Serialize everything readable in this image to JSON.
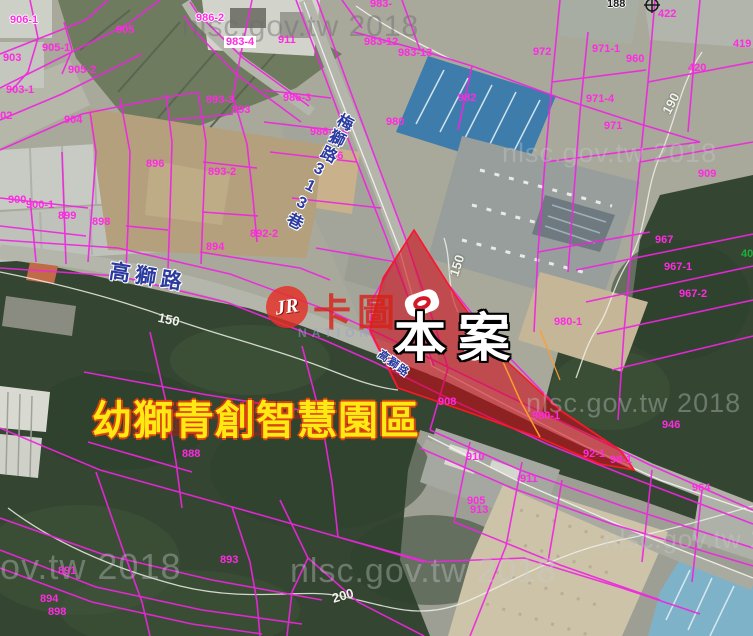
{
  "map": {
    "site_label": "本案",
    "park_label": "幼獅青創智慧園區",
    "ghost_row": "卡圖卡圖卡圖",
    "topmark": "188",
    "logo": {
      "jr": "JR",
      "cn": "卡圖",
      "sub": "NATION"
    },
    "watermarks": [
      {
        "text": "nlsc.gov.tw 2018",
        "x": 182,
        "y": 10,
        "s": 30,
        "dark": 1
      },
      {
        "text": "nlsc.gov.tw 2018",
        "x": 502,
        "y": 138,
        "s": 27,
        "dark": 0
      },
      {
        "text": "nlsc.gov.tw 2018",
        "x": 526,
        "y": 388,
        "s": 27,
        "dark": 0
      },
      {
        "text": "nlsc.gov.tw 2018",
        "x": -100,
        "y": 546,
        "s": 36,
        "dark": 0
      },
      {
        "text": "nlsc.gov.tw 2018",
        "x": 290,
        "y": 552,
        "s": 34,
        "dark": 0
      },
      {
        "text": "nlsc.gov.tw 2018",
        "x": 604,
        "y": 524,
        "s": 26,
        "dark": 0
      }
    ],
    "road_labels": [
      {
        "text": "高獅路",
        "x": 112,
        "y": 255,
        "r": 9,
        "s": 21,
        "ls": 5,
        "vertical": 0
      },
      {
        "text": "梅獅路313巷",
        "x": 336,
        "y": 108,
        "r": 27,
        "s": 16,
        "ls": 2,
        "vertical": 1
      },
      {
        "text": "高獅路",
        "x": 384,
        "y": 346,
        "r": 36,
        "s": 11,
        "ls": 1,
        "vertical": 0
      }
    ],
    "contour_labels": [
      {
        "v": "150",
        "x": 158,
        "y": 312,
        "r": 12
      },
      {
        "v": "150",
        "x": 446,
        "y": 258,
        "r": -72
      },
      {
        "v": "190",
        "x": 660,
        "y": 96,
        "r": -62
      },
      {
        "v": "200",
        "x": 332,
        "y": 588,
        "r": -16
      }
    ],
    "parcels": [
      {
        "id": "906-1",
        "x": 10,
        "y": 14,
        "w": 1
      },
      {
        "id": "986-2",
        "x": 196,
        "y": 12,
        "w": 1
      },
      {
        "id": "905",
        "x": 116,
        "y": 24
      },
      {
        "id": "905-1",
        "x": 42,
        "y": 42
      },
      {
        "id": "903",
        "x": 3,
        "y": 52
      },
      {
        "id": "905-2",
        "x": 68,
        "y": 64
      },
      {
        "id": "903-1",
        "x": 6,
        "y": 84
      },
      {
        "id": "902",
        "x": -6,
        "y": 110
      },
      {
        "id": "904",
        "x": 64,
        "y": 114
      },
      {
        "id": "893-3",
        "x": 206,
        "y": 94
      },
      {
        "id": "893",
        "x": 232,
        "y": 104
      },
      {
        "id": "896",
        "x": 146,
        "y": 158
      },
      {
        "id": "893-2",
        "x": 208,
        "y": 166
      },
      {
        "id": "892-2",
        "x": 250,
        "y": 228
      },
      {
        "id": "894",
        "x": 206,
        "y": 241
      },
      {
        "id": "900",
        "x": 8,
        "y": 194
      },
      {
        "id": "900-1",
        "x": 26,
        "y": 199
      },
      {
        "id": "899",
        "x": 58,
        "y": 210
      },
      {
        "id": "898",
        "x": 92,
        "y": 216
      },
      {
        "id": "911",
        "x": 278,
        "y": 34
      },
      {
        "id": "983-4",
        "x": 224,
        "y": 36,
        "box": 1
      },
      {
        "id": "983-",
        "x": 370,
        "y": -2
      },
      {
        "id": "983-12",
        "x": 364,
        "y": 36
      },
      {
        "id": "983-13",
        "x": 398,
        "y": 47
      },
      {
        "id": "986-3",
        "x": 283,
        "y": 92
      },
      {
        "id": "980",
        "x": 386,
        "y": 116
      },
      {
        "id": "986-1",
        "x": 310,
        "y": 126
      },
      {
        "id": "986",
        "x": 325,
        "y": 150
      },
      {
        "id": "982",
        "x": 458,
        "y": 92
      },
      {
        "id": "972",
        "x": 533,
        "y": 46
      },
      {
        "id": "971-1",
        "x": 592,
        "y": 43
      },
      {
        "id": "960",
        "x": 626,
        "y": 53
      },
      {
        "id": "422",
        "x": 658,
        "y": 8
      },
      {
        "id": "420",
        "x": 688,
        "y": 62
      },
      {
        "id": "419",
        "x": 733,
        "y": 38
      },
      {
        "id": "971-4",
        "x": 586,
        "y": 93
      },
      {
        "id": "971",
        "x": 604,
        "y": 120
      },
      {
        "id": "909",
        "x": 698,
        "y": 168
      },
      {
        "id": "967",
        "x": 655,
        "y": 234
      },
      {
        "id": "967-1",
        "x": 664,
        "y": 261
      },
      {
        "id": "967-2",
        "x": 679,
        "y": 288
      },
      {
        "id": "40",
        "x": 741,
        "y": 248,
        "green": 1
      },
      {
        "id": "980-1",
        "x": 554,
        "y": 316
      },
      {
        "id": "908",
        "x": 438,
        "y": 396
      },
      {
        "id": "980-1",
        "x": 532,
        "y": 410
      },
      {
        "id": "946",
        "x": 662,
        "y": 419
      },
      {
        "id": "92-1",
        "x": 583,
        "y": 448
      },
      {
        "id": "98-1",
        "x": 610,
        "y": 454
      },
      {
        "id": "964",
        "x": 692,
        "y": 482
      },
      {
        "id": "910",
        "x": 466,
        "y": 451
      },
      {
        "id": "911",
        "x": 520,
        "y": 473
      },
      {
        "id": "905",
        "x": 467,
        "y": 495
      },
      {
        "id": "913",
        "x": 470,
        "y": 504
      },
      {
        "id": "888",
        "x": 182,
        "y": 448
      },
      {
        "id": "891",
        "x": 58,
        "y": 565
      },
      {
        "id": "894",
        "x": 40,
        "y": 593
      },
      {
        "id": "898",
        "x": 48,
        "y": 606
      },
      {
        "id": "893",
        "x": 220,
        "y": 554
      }
    ]
  }
}
